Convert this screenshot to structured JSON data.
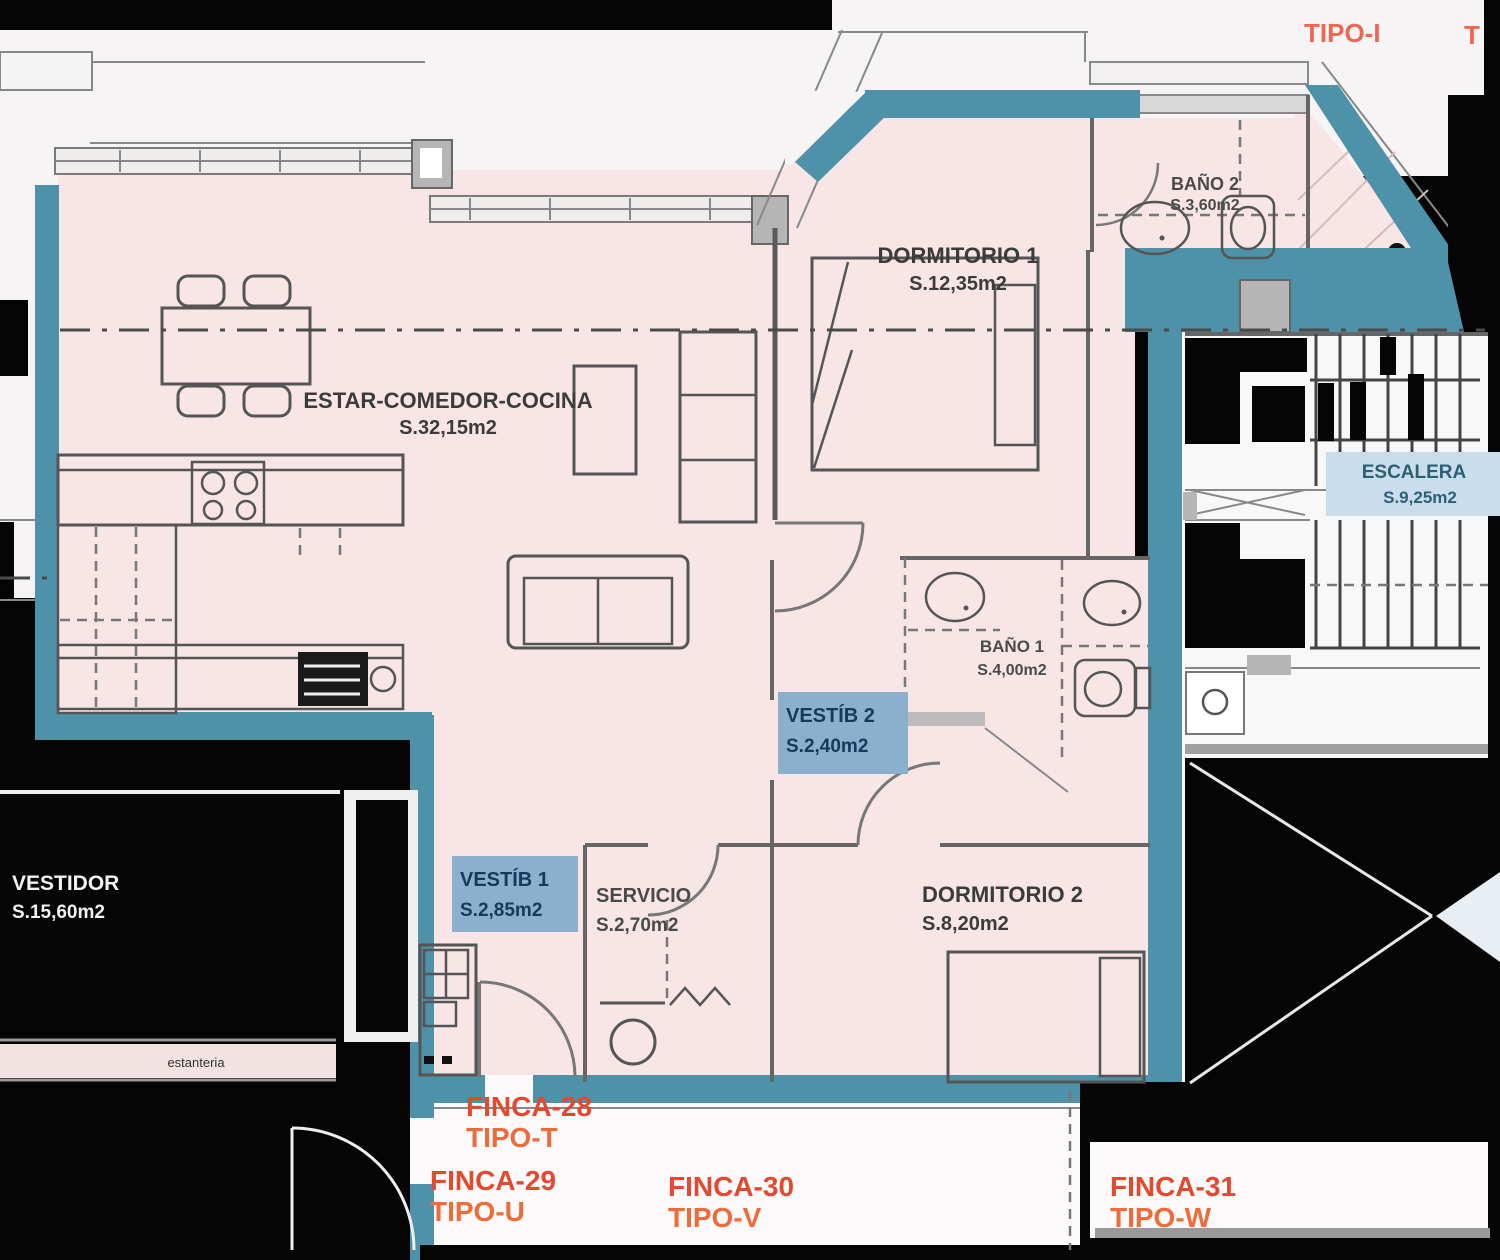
{
  "rooms": {
    "estar": {
      "name": "ESTAR-COMEDOR-COCINA",
      "area": "S.32,15m2"
    },
    "dormitorio1": {
      "name": "DORMITORIO 1",
      "area": "S.12,35m2"
    },
    "banyo2": {
      "name": "BAÑO 2",
      "area": "S.3,60m2"
    },
    "banyo1": {
      "name": "BAÑO 1",
      "area": "S.4,00m2"
    },
    "vestib2": {
      "name": "VESTÍB 2",
      "area": "S.2,40m2"
    },
    "vestib1": {
      "name": "VESTÍB 1",
      "area": "S.2,85m2"
    },
    "servicio": {
      "name": "SERVICIO",
      "area": "S.2,70m2"
    },
    "dormitorio2": {
      "name": "DORMITORIO 2",
      "area": "S.8,20m2"
    },
    "vestidor": {
      "name": "VESTIDOR",
      "area": "S.15,60m2"
    },
    "escalera": {
      "name": "ESCALERA",
      "area": "S.9,25m2"
    }
  },
  "units": {
    "tipo_i": "TIPO-I",
    "tipo_i_partial": "T",
    "finca28": {
      "finca": "FINCA-28",
      "tipo": "TIPO-T"
    },
    "finca29": {
      "finca": "FINCA-29",
      "tipo": "TIPO-U"
    },
    "finca30": {
      "finca": "FINCA-30",
      "tipo": "TIPO-V"
    },
    "finca31": {
      "finca": "FINCA-31",
      "tipo": "TIPO-W"
    }
  },
  "annotations": {
    "estanteria": "estanteria"
  },
  "colors": {
    "wall_teal": "#4e92aa",
    "floor_pink": "#f8e6e6",
    "exterior_white": "#f6f4f4",
    "unit_label_red": "#e2492e",
    "unit_label_orange": "#ed6d3a",
    "highlight_label_bg": "#8ab0cb",
    "highlight_label_text": "#17395c",
    "escalera_bg": "#c9dded",
    "escalera_text": "#2a6173",
    "background_black": "#050505"
  }
}
